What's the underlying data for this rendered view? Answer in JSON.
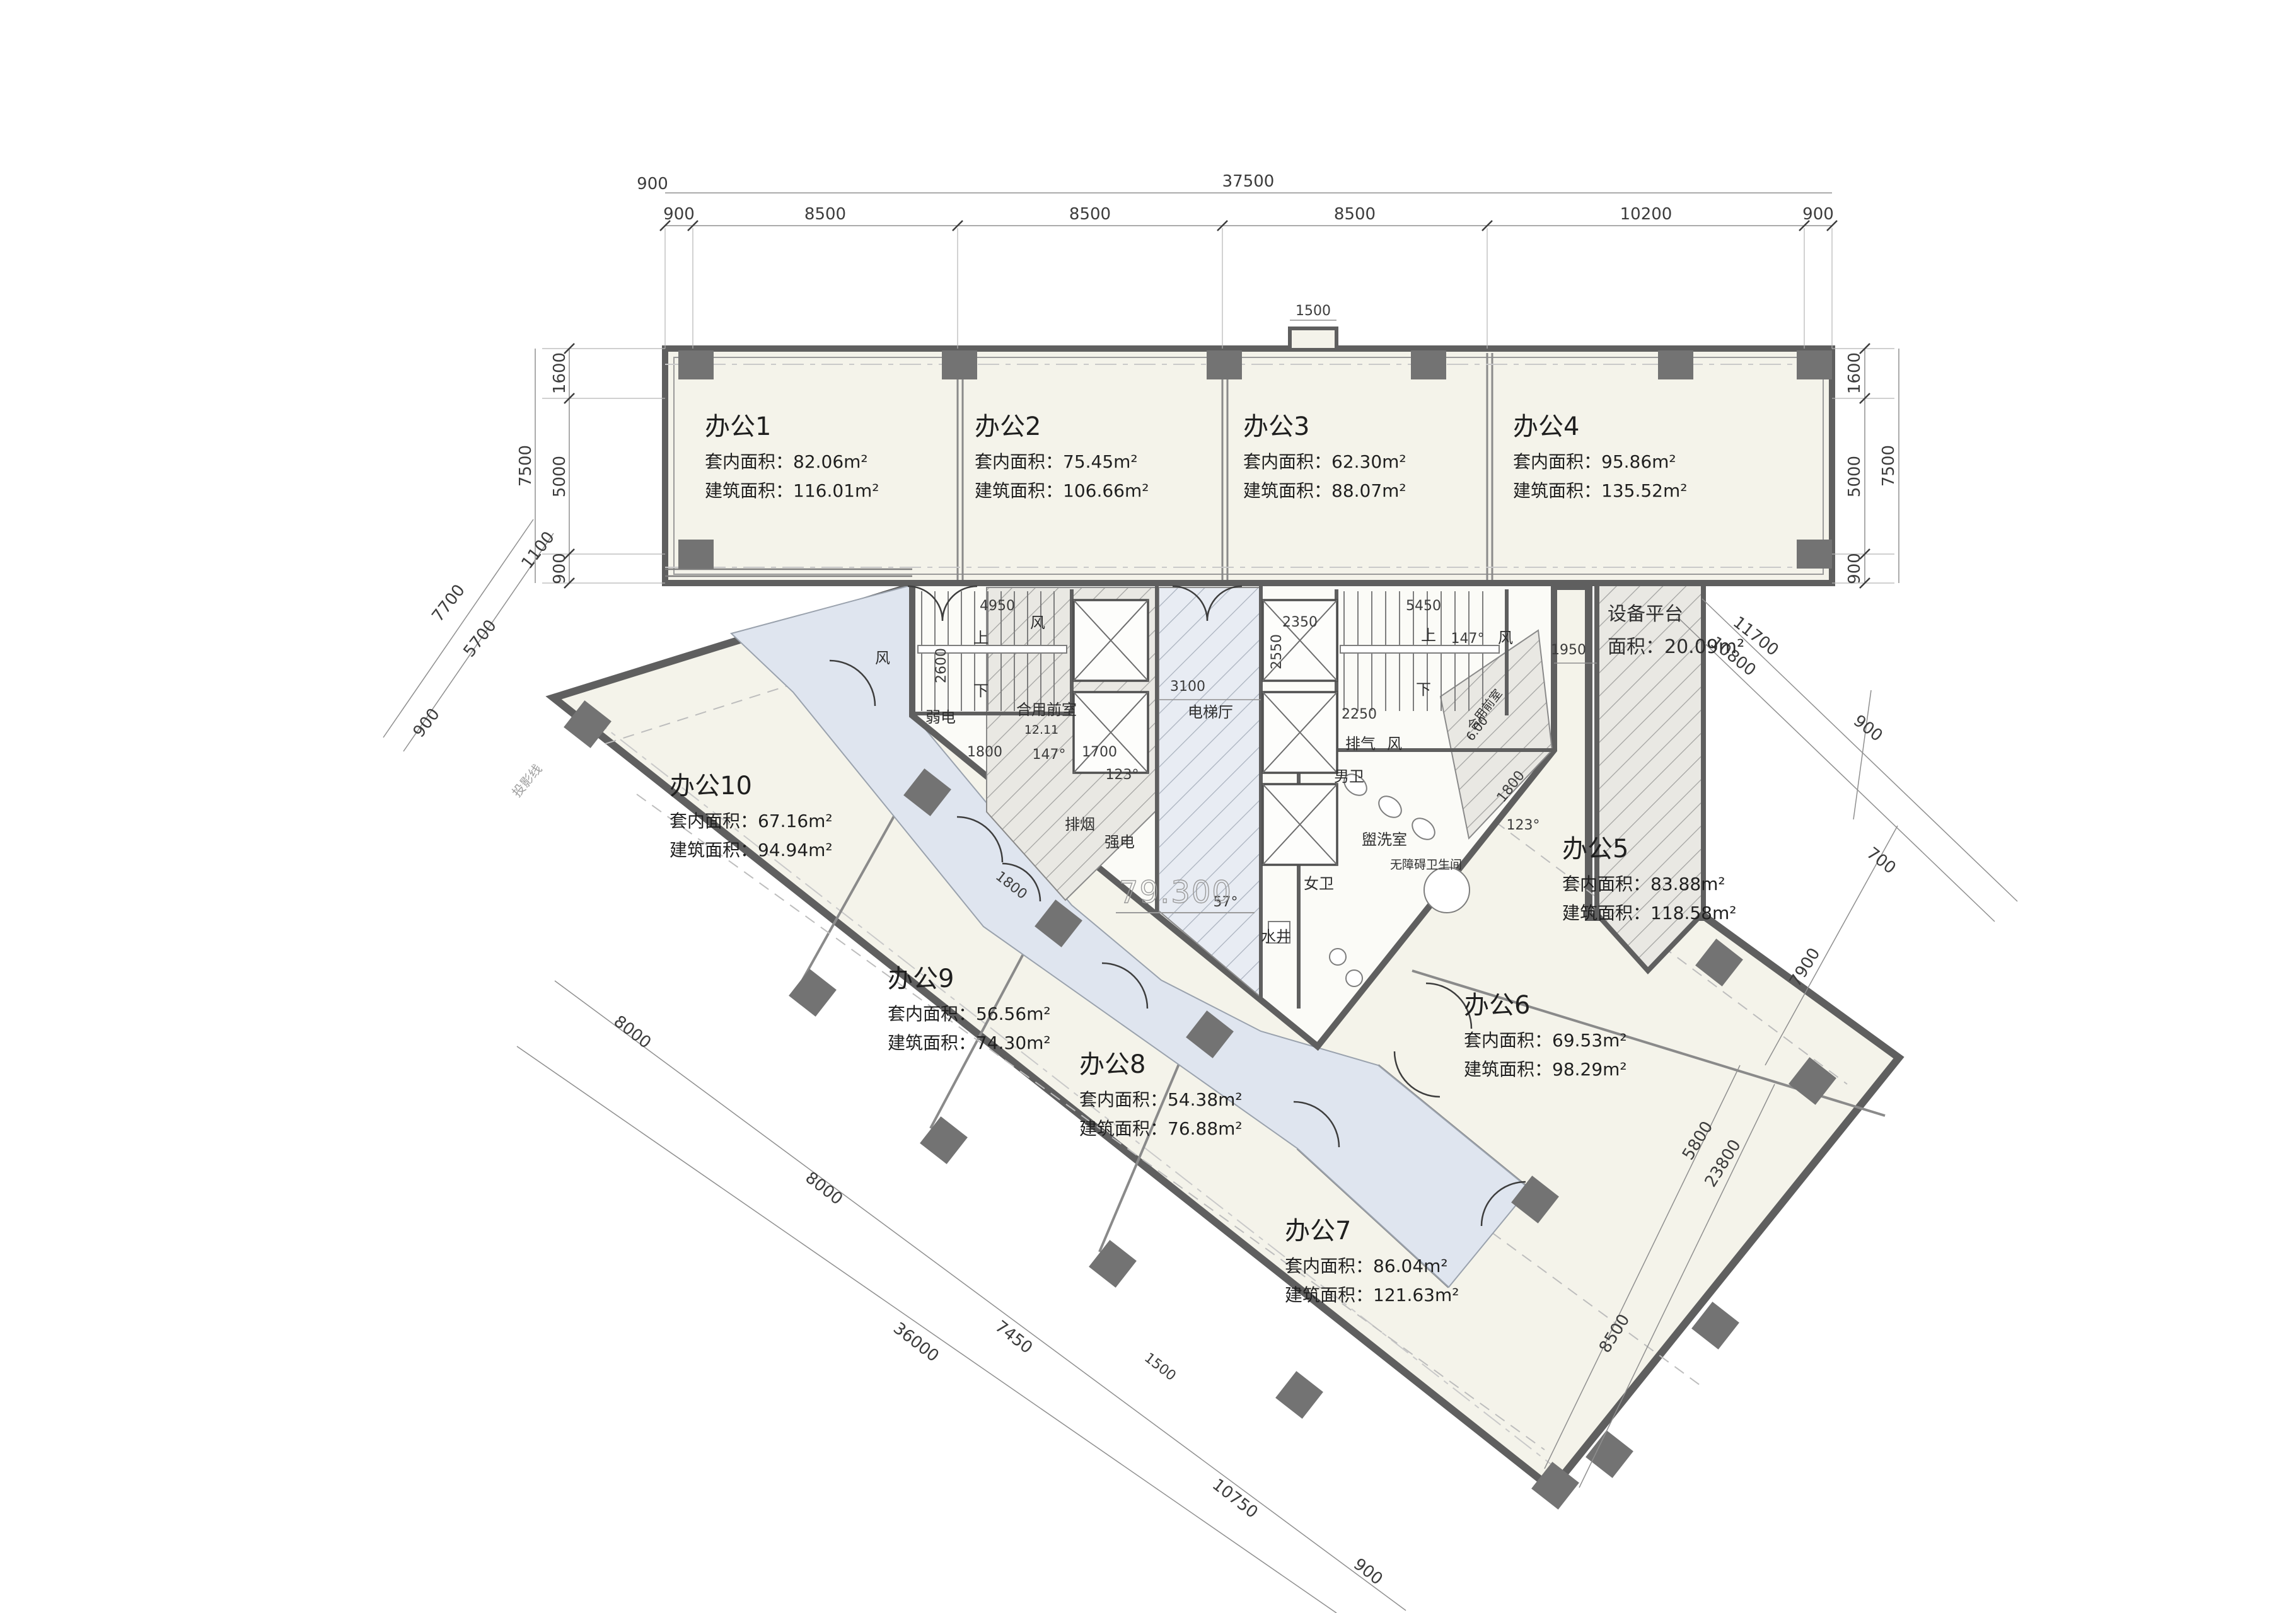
{
  "title": "办公楼层平面图",
  "colors": {
    "wall": "#5f5f5f",
    "column": "#737373",
    "office_fill": "#f4f3ea",
    "corridor_fill": "#dfe5ef",
    "hatch_line": "#9b9b9b",
    "dim_text": "#3c3c3c"
  },
  "offices": [
    {
      "name": "办公1",
      "inner": "套内面积：82.06m²",
      "gross": "建筑面积：116.01m²"
    },
    {
      "name": "办公2",
      "inner": "套内面积：75.45m²",
      "gross": "建筑面积：106.66m²"
    },
    {
      "name": "办公3",
      "inner": "套内面积：62.30m²",
      "gross": "建筑面积：88.07m²"
    },
    {
      "name": "办公4",
      "inner": "套内面积：95.86m²",
      "gross": "建筑面积：135.52m²"
    },
    {
      "name": "办公5",
      "inner": "套内面积：83.88m²",
      "gross": "建筑面积：118.58m²"
    },
    {
      "name": "办公6",
      "inner": "套内面积：69.53m²",
      "gross": "建筑面积：98.29m²"
    },
    {
      "name": "办公7",
      "inner": "套内面积：86.04m²",
      "gross": "建筑面积：121.63m²"
    },
    {
      "name": "办公8",
      "inner": "套内面积：54.38m²",
      "gross": "建筑面积：76.88m²"
    },
    {
      "name": "办公9",
      "inner": "套内面积：56.56m²",
      "gross": "建筑面积：74.30m²"
    },
    {
      "name": "办公10",
      "inner": "套内面积：67.16m²",
      "gross": "建筑面积：94.94m²"
    }
  ],
  "platform": {
    "name": "设备平台",
    "area": "面积：20.09m²"
  },
  "core": {
    "fan": "风",
    "weak": "弱电",
    "strong": "强电",
    "smoke": "排烟",
    "exhaust": "排气",
    "front1": "合用前室",
    "front1_area": "12.11",
    "front2": "合用前室",
    "front2_area": "6.00",
    "hall": "电梯厅",
    "male": "男卫",
    "female": "女卫",
    "acc": "无障碍卫生间",
    "wash": "盥洗室",
    "well": "水井",
    "up": "上",
    "down": "下",
    "level": "79.300"
  },
  "misc": {
    "projection": "投影线"
  },
  "dims": {
    "top_total": "37500",
    "top": [
      "900",
      "8500",
      "8500",
      "8500",
      "10200",
      "900"
    ],
    "left": [
      "1600",
      "5000",
      "900"
    ],
    "left_total": "7500",
    "right": [
      "1600",
      "5000",
      "900"
    ],
    "right_total": "7500",
    "top_left": "900",
    "notch": "1500",
    "nw": [
      "1100",
      "7700",
      "5700",
      "900"
    ],
    "sw": [
      "8000",
      "8000",
      "7450",
      "10750",
      "900"
    ],
    "sw_total": "36000",
    "sw_jog": "1500",
    "right_chain": [
      "8500",
      "5800",
      "7900",
      "700",
      "900"
    ],
    "right_total2": "23800",
    "platform_chain": [
      "11700",
      "10800"
    ],
    "core": {
      "c4950": "4950",
      "c2600": "2600",
      "c1800": "1800",
      "c1700": "1700",
      "c3100": "3100",
      "c5450": "5450",
      "c2250": "2250",
      "c2350": "2350",
      "c2550": "2550",
      "c1800b": "1800",
      "c1800c": "1800",
      "c1950": "1950"
    },
    "angles": {
      "a57": "57°",
      "a123": "123°",
      "a147": "147°"
    }
  }
}
